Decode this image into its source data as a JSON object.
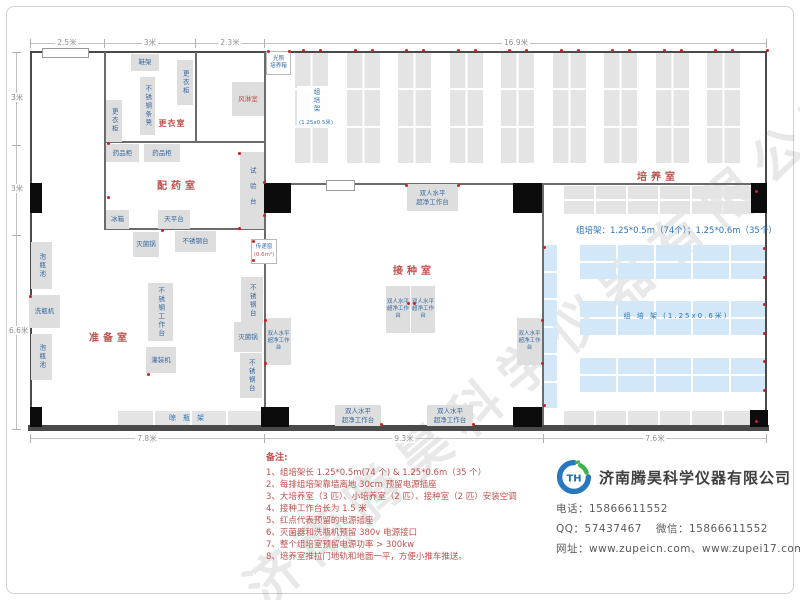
{
  "watermark": "济南腾昊科学仪器有限公司",
  "dims": {
    "top": [
      "2.5米",
      "3米",
      "2.3米",
      "16.9米"
    ],
    "left": [
      "3米",
      "3米",
      "6.6米"
    ],
    "bottom": [
      "7.8米",
      "9.3米",
      "7.6米"
    ]
  },
  "rooms": {
    "changing": "更衣室",
    "air_shower": "风淋室",
    "dispensing": "配药室",
    "prep": "准备室",
    "inoculation": "接种室",
    "culture": "培养室"
  },
  "equipment": {
    "shoe_rack": "鞋架",
    "wardrobe": "更衣柜",
    "steel_bench": "不锈钢条凳",
    "light_incubator": "光照\n培养箱",
    "medicine_cabinet": "药品柜",
    "fridge": "冰箱",
    "balance_table": "天平台",
    "test_bench": "试验台",
    "sterilizer": "灭菌锅",
    "steel_table": "不锈钢台",
    "pass_window": "传递窗",
    "pass_window_size": "(0.6m²)",
    "bottle_pool": "泡瓶池",
    "bottle_washer": "洗瓶机",
    "steel_workbench": "不锈钢工作台",
    "filling_machine": "灌装机",
    "drying_rack": "晾瓶架",
    "clean_bench": "双人水平\n超净工作台",
    "rack_v_label": "组培架",
    "rack_v_size": "(1.25x0.5米)",
    "rack_big_label": "组 培 架 (1.25x0.6米)",
    "rack_spec": "组培架：1.25*0.5m（74个）；1.25*0.6m（35个）"
  },
  "notes": {
    "title": "备注:",
    "items": [
      "1、组培架长 1.25*0.5m(74 个) & 1.25*0.6m（35 个）",
      "2、每排组培架靠墙离地 30cm 预留电源插座",
      "3、大培养室（3 匹）、小培养室（2 匹）、接种室（2 匹）安装空调",
      "4、接种工作台长为 1.5 米",
      "5、红点代表预留的电源插座",
      "6、灭菌器和洗瓶机预留 380v 电源接口",
      "7、整个组培室预留电源功率 > 300kw",
      "8、培养室推拉门地轨和地面一平，方便小推车推送。"
    ]
  },
  "company": {
    "name": "济南腾昊科学仪器有限公司",
    "phone_label": "电话：",
    "phone": "15866611552",
    "qq_label": "QQ：",
    "qq": "57437467",
    "wechat_label": "微信：",
    "wechat": "15866611552",
    "web_label": "网址：",
    "websites": "www.zupeicn.com、www.zupei17.com"
  }
}
